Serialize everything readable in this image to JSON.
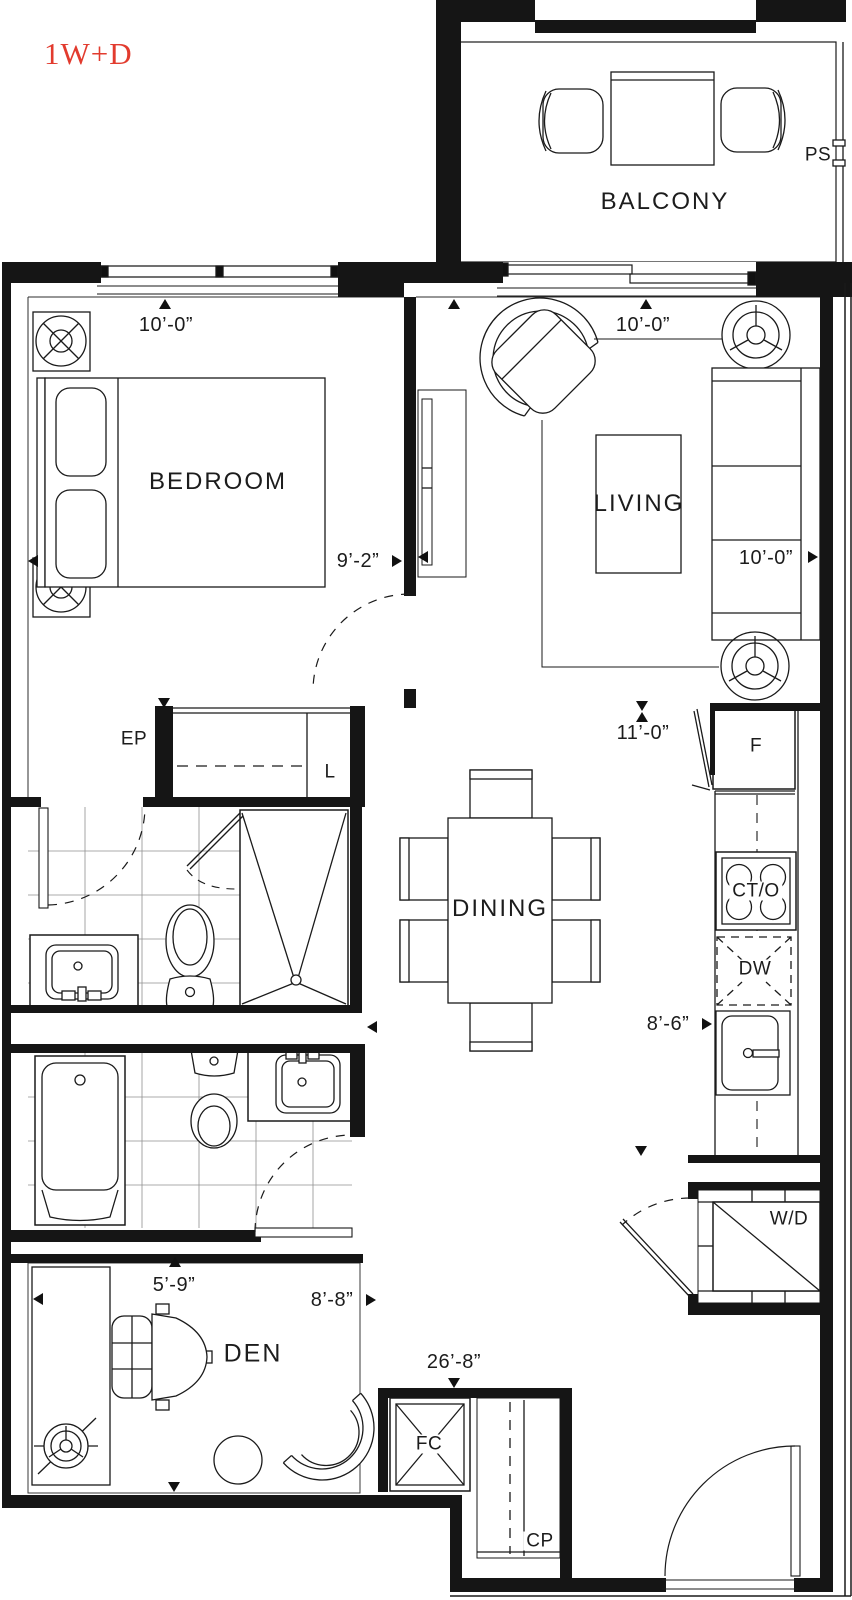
{
  "title": "1W+D",
  "colors": {
    "title_red": "#e23b2e",
    "line": "#1a1a1a"
  },
  "rooms": {
    "balcony": "BALCONY",
    "bedroom": "BEDROOM",
    "living": "LIVING",
    "dining": "DINING",
    "den": "DEN"
  },
  "labels": {
    "privacy_screen": "PS",
    "electrical_panel": "EP",
    "linen": "L",
    "fridge": "F",
    "cooktop_oven": "CT/O",
    "dishwasher": "DW",
    "washer_dryer": "W/D",
    "fan_coil": "FC",
    "coat_closet": "CP"
  },
  "dimensions": {
    "bedroom_depth": "10’-0”",
    "bedroom_width": "9’-2”",
    "living_depth": "10’-0”",
    "living_width": "10’-0”",
    "hall_depth": "11’-0”",
    "kitchen_width": "8’-6”",
    "den_depth": "5’-9”",
    "den_width": "8’-8”",
    "overall_depth": "26’-8”"
  }
}
